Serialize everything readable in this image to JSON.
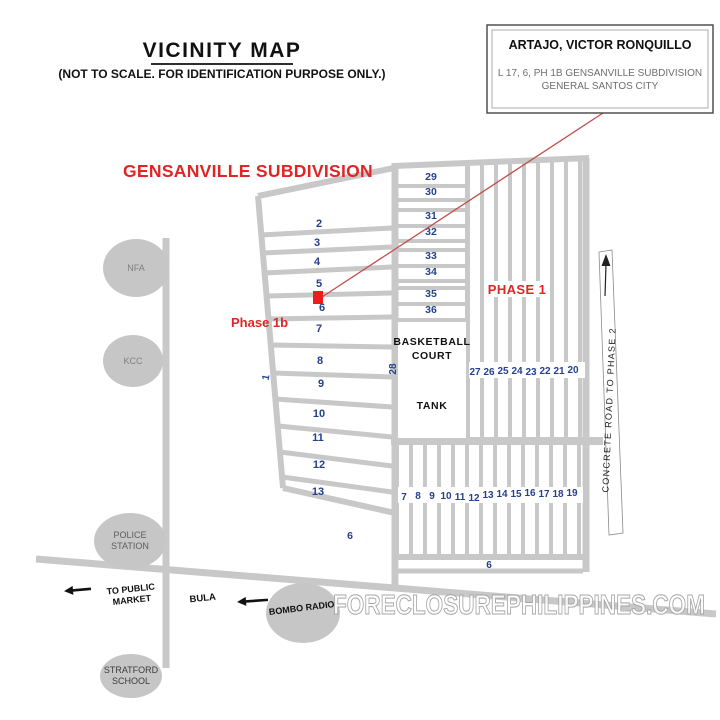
{
  "title": {
    "text": "VICINITY MAP",
    "subtitle": "(NOT TO SCALE. FOR IDENTIFICATION PURPOSE ONLY.)"
  },
  "info_box": {
    "name": "ARTAJO, VICTOR RONQUILLO",
    "address_line1": "L 17, 6, PH 1B GENSANVILLE SUBDIVISION",
    "address_line2": "GENERAL SANTOS CITY"
  },
  "labels": {
    "subdivision": "GENSANVILLE SUBDIVISION",
    "phase_1b": "Phase 1b",
    "phase_1": "PHASE 1",
    "basketball_line1": "BASKETBALL",
    "basketball_line2": "COURT",
    "tank": "TANK",
    "concrete_road": "CONCRETE ROAD TO PHASE 2",
    "bula": "BULA",
    "to_public_market_line1": "TO PUBLIC",
    "to_public_market_line2": "MARKET",
    "bombo_radio": "BOMBO RADIO"
  },
  "landmarks": {
    "nfa": "NFA",
    "kcc": "KCC",
    "police_line1": "POLICE",
    "police_line2": "STATION",
    "stratford_line1": "STRATFORD",
    "stratford_line2": "SCHOOL"
  },
  "lots": {
    "phase1b_rows": [
      "2",
      "3",
      "4",
      "5",
      "6",
      "7",
      "8",
      "9",
      "10",
      "11",
      "12",
      "13"
    ],
    "phase1b_side": "1",
    "phase1b_bottom_block": "6",
    "upper_column": [
      "29",
      "30",
      "31",
      "32",
      "33",
      "34",
      "35",
      "36"
    ],
    "middle_row": [
      "27",
      "26",
      "25",
      "24",
      "23",
      "22",
      "21",
      "20"
    ],
    "lane": "28",
    "bottom_row": [
      "7",
      "8",
      "9",
      "10",
      "11",
      "12",
      "13",
      "14",
      "15",
      "16",
      "17",
      "18",
      "19"
    ],
    "bottom_strip": "6"
  },
  "watermark": "FORECLOSUREPHILIPPINES.COM",
  "colors": {
    "road": "#c8c8c8",
    "lot_number": "#24418e",
    "red_label": "#e02525",
    "callout_line": "#c0504d",
    "marker_red": "#ee1c1c",
    "landmark_fill": "#c6c6c6"
  }
}
